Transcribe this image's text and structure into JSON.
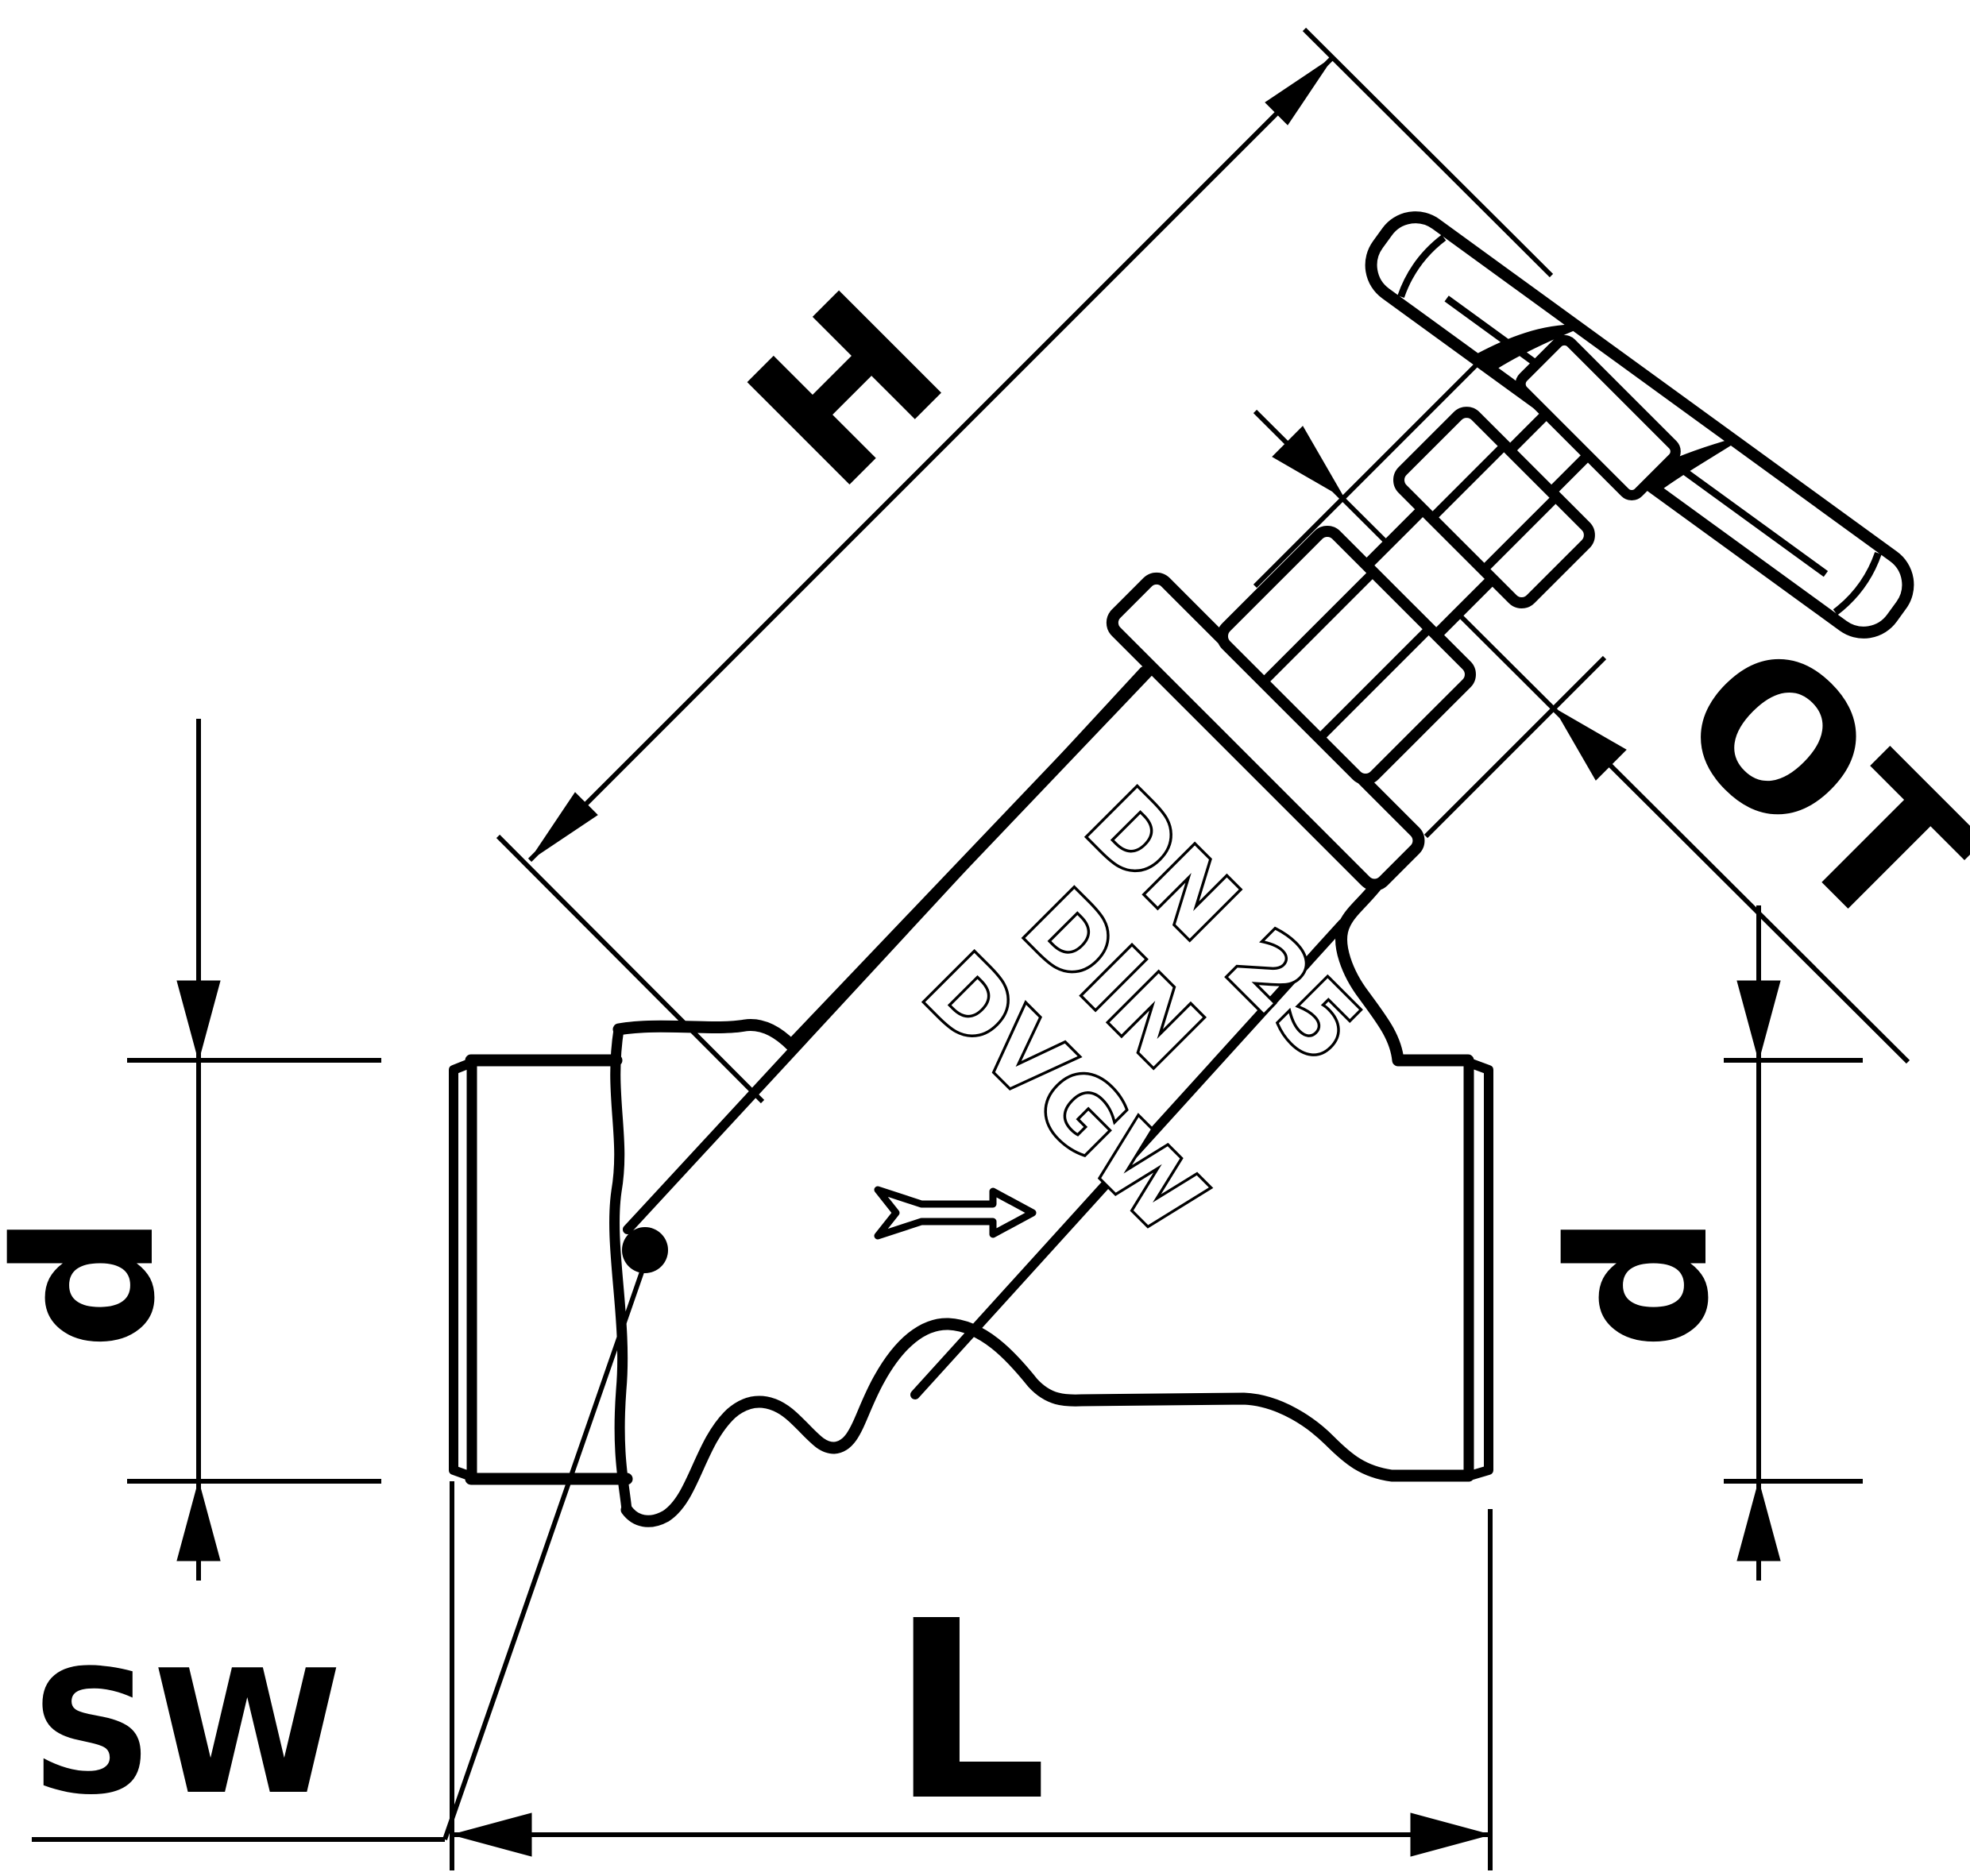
{
  "page": {
    "background": "#ffffff",
    "ink": "#000000"
  },
  "drawing": {
    "type": "technical-line-drawing",
    "subject": "inclined-seat valve with 45-degree bonnet and handwheel, side elevation",
    "labels": {
      "height": "H",
      "top_assembly": "OT",
      "diameter_left": "d",
      "diameter_right": "d",
      "length": "L",
      "wrench_size": "SW"
    },
    "cast_markings": {
      "line1": "DN 25",
      "line2": "DIN",
      "line3": "DVGW"
    },
    "flow_direction": "right"
  }
}
